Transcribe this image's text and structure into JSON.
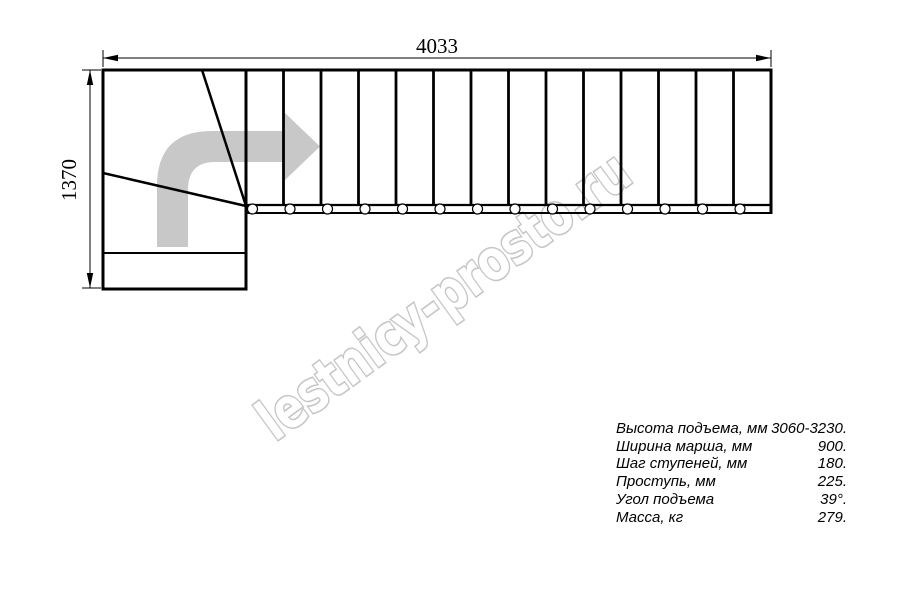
{
  "title": "Staircase plan drawing",
  "dimensions": {
    "width_label": "4033",
    "height_label": "1370"
  },
  "plan": {
    "straight_steps": 14,
    "circle_radius": 5,
    "has_direction_arrow": true
  },
  "watermark": {
    "text": "lestnicy-prosto.ru",
    "color": "#c6c6c6"
  },
  "colors": {
    "line": "#000000",
    "arrow_fill": "#c8c8c8",
    "background": "#ffffff"
  },
  "specs": {
    "rows": [
      {
        "label": "Высота подъема, мм",
        "value": "3060-3230."
      },
      {
        "label": "Ширина марша, мм",
        "value": "900."
      },
      {
        "label": "Шаг ступеней, мм",
        "value": "180."
      },
      {
        "label": "Проступь, мм",
        "value": "225."
      },
      {
        "label": "Угол подъема",
        "value": "39°."
      },
      {
        "label": "Масса, кг",
        "value": "279."
      }
    ]
  }
}
